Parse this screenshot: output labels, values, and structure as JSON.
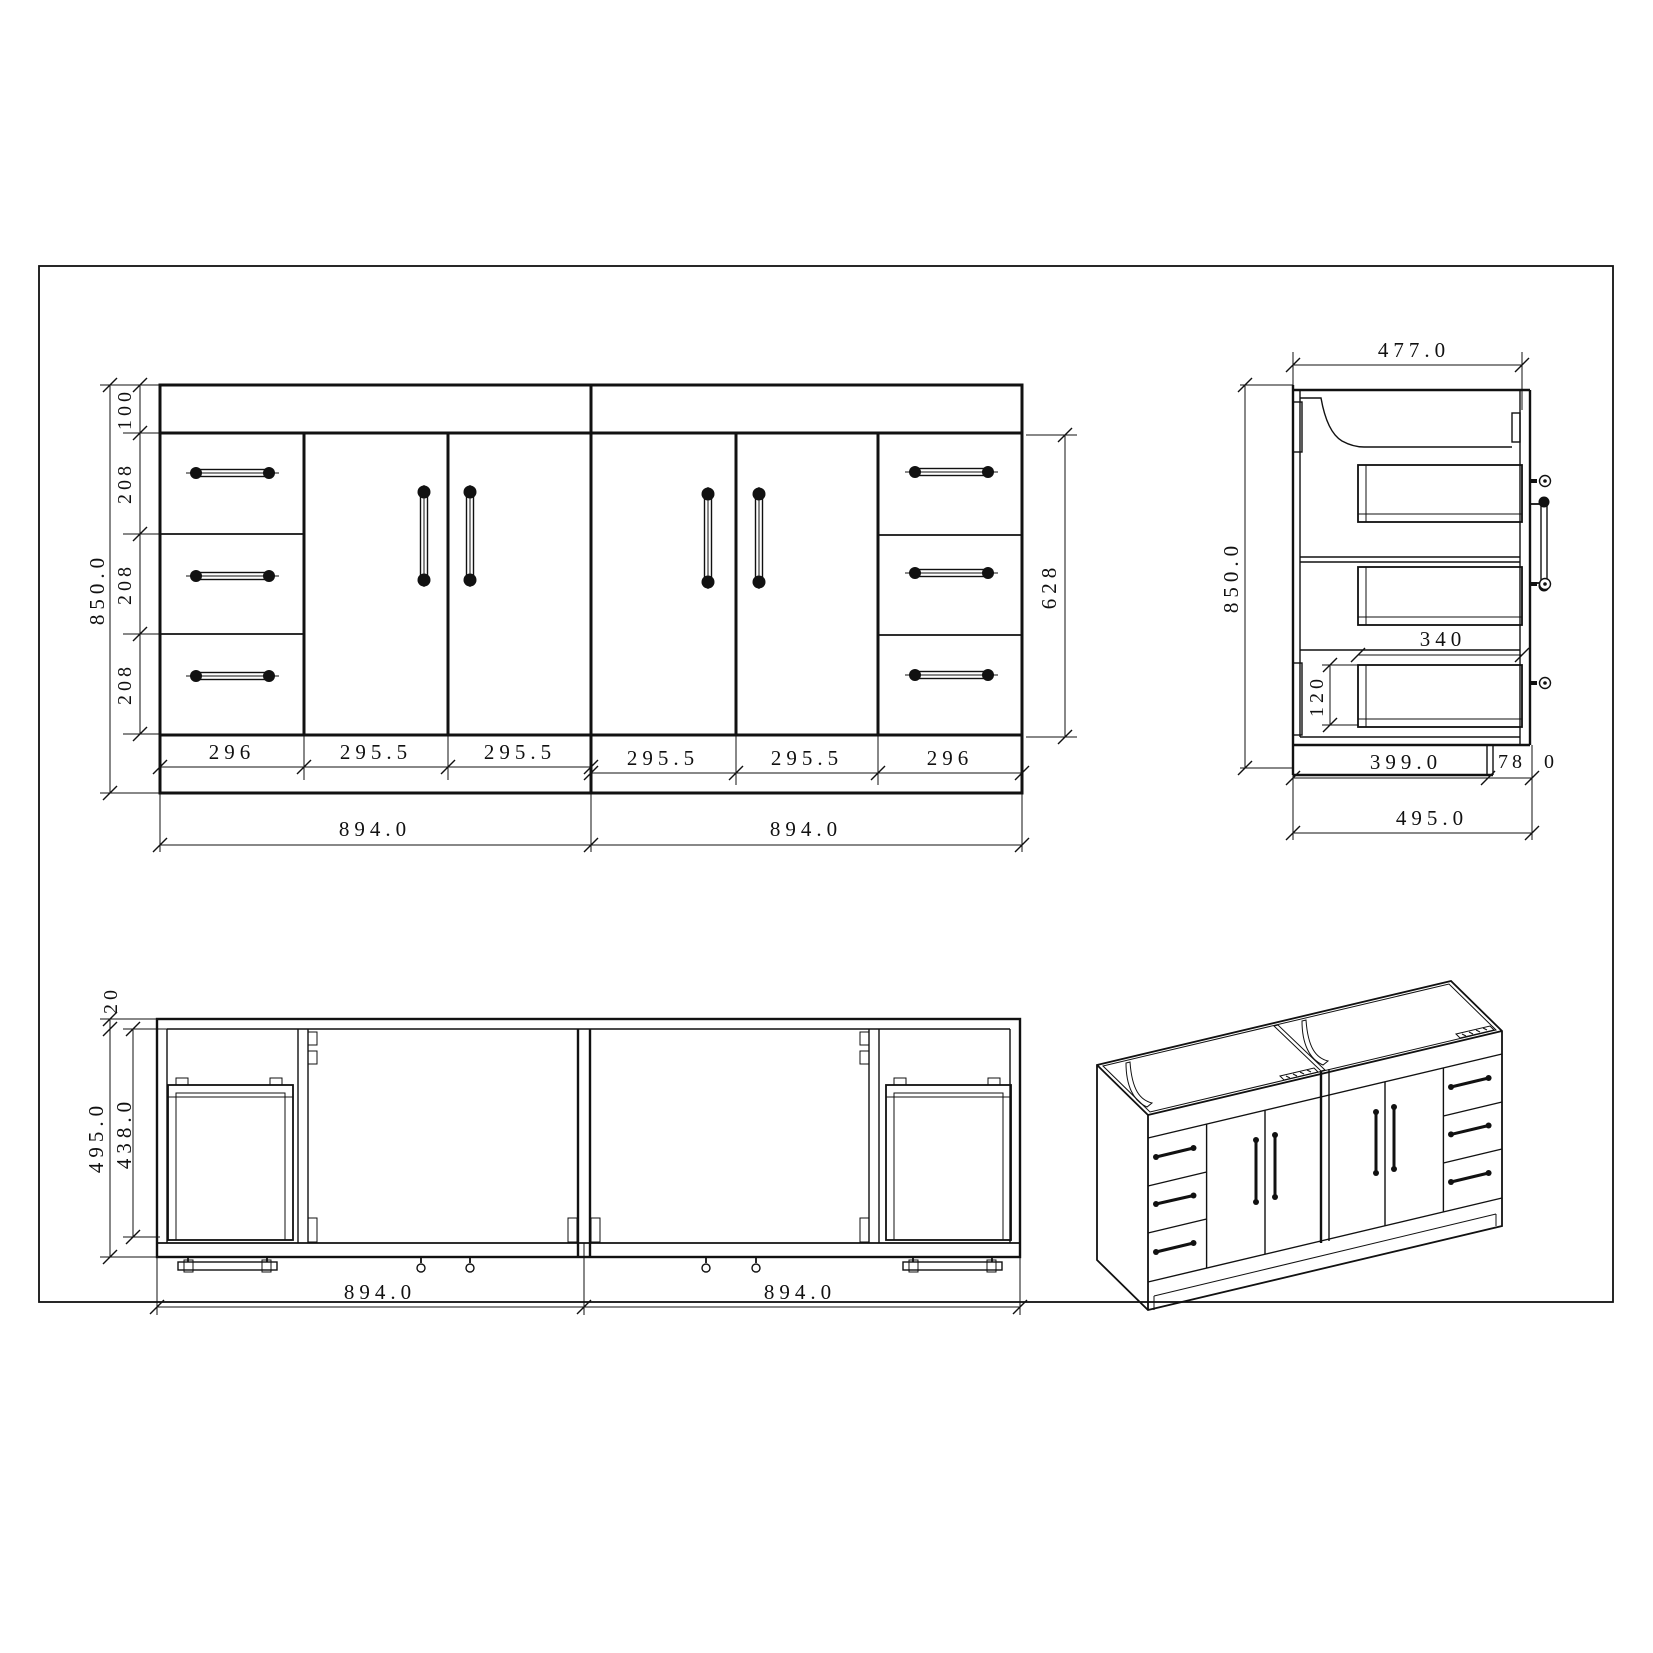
{
  "page": {
    "background": "#ffffff",
    "line_color": "#111111"
  },
  "views": {
    "front": {
      "name": "front-elevation",
      "dims": {
        "overall_height": "850.0",
        "top_rail": "100",
        "drawer_1": "208",
        "drawer_2": "208",
        "drawer_3": "208",
        "front_opening": "628",
        "w_1": "296",
        "w_2": "295.5",
        "w_3": "295.5",
        "w_4": "295.5",
        "w_5": "295.5",
        "w_6": "296",
        "module_left": "894.0",
        "module_right": "894.0"
      }
    },
    "side": {
      "name": "side-section",
      "dims": {
        "top_width": "477.0",
        "overall_height": "850.0",
        "drawer_depth": "340",
        "drawer_front_height": "120",
        "bottom_inner": "399.0",
        "bottom_front": "78",
        "bottom_front_tail": "0",
        "overall_depth": "495.0"
      }
    },
    "plan": {
      "name": "plan-view",
      "dims": {
        "back_rail": "20",
        "inner_depth": "438.0",
        "overall_depth": "495.0",
        "module_left": "894.0",
        "module_right": "894.0"
      }
    },
    "iso": {
      "name": "isometric-view"
    }
  }
}
